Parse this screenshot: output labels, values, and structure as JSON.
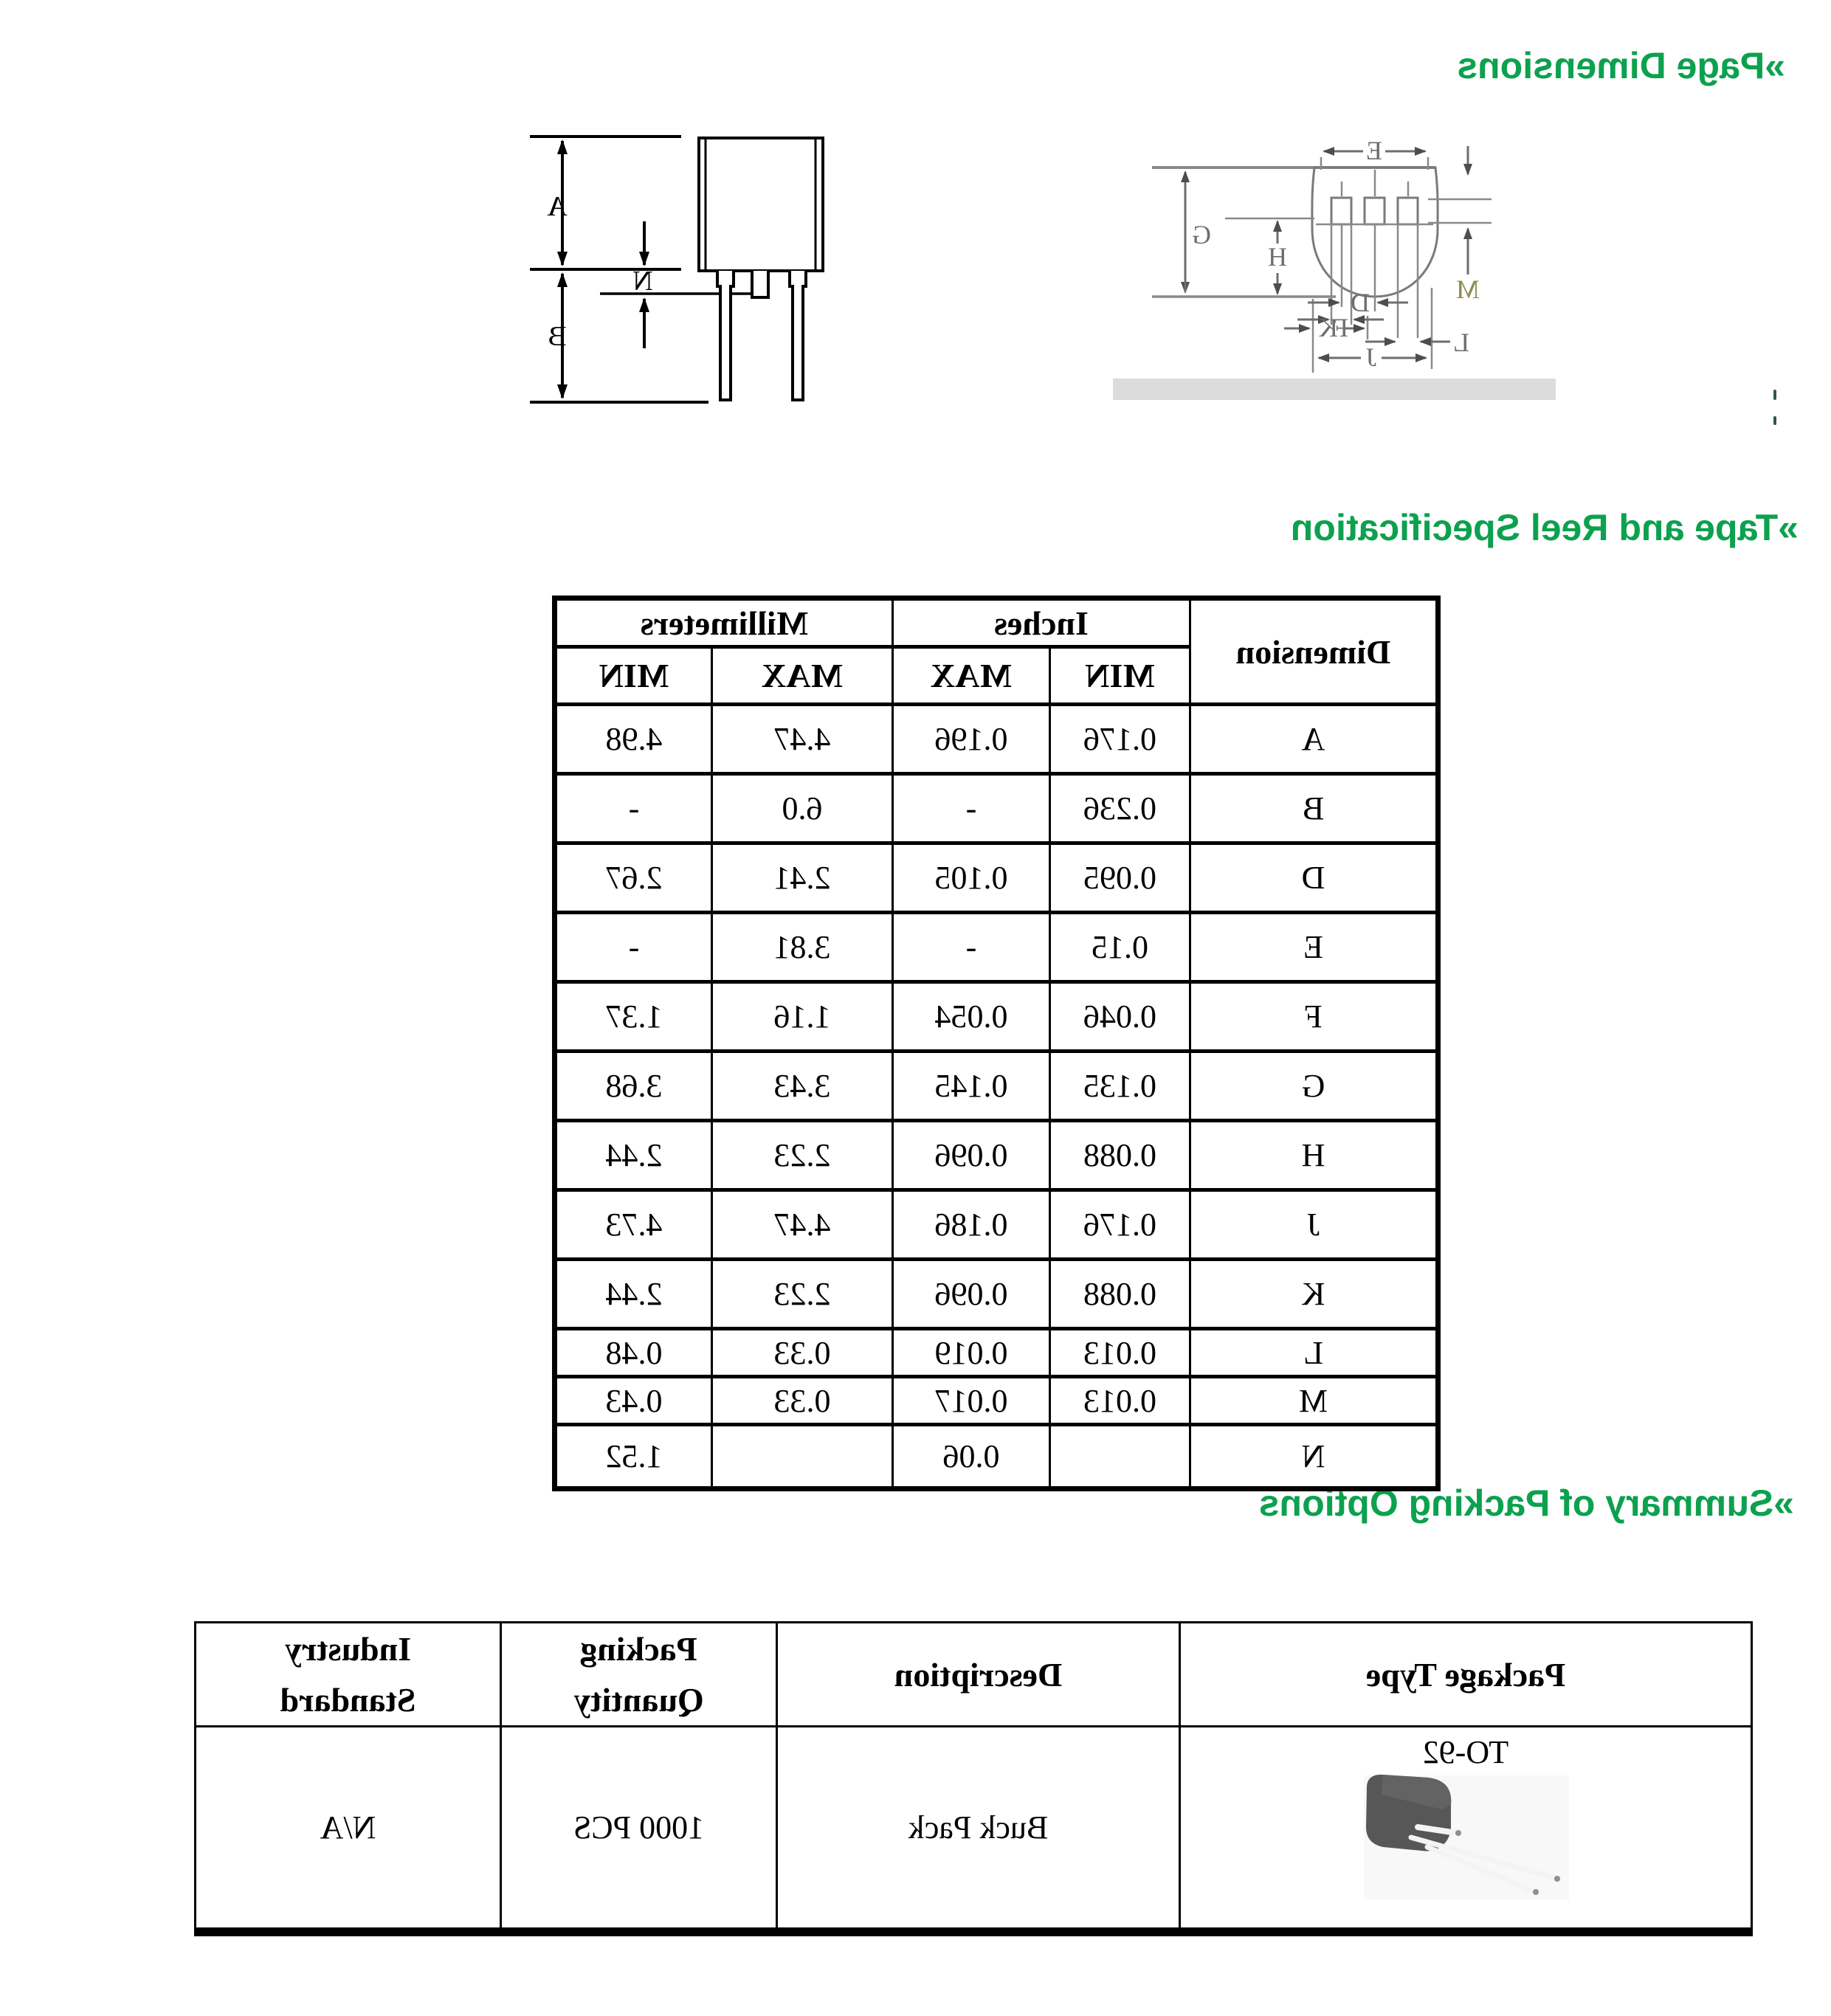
{
  "headings": {
    "h1": "»Page Dimensions",
    "h2": "»Tape and Reel Specification",
    "h3": "»Summary of Packing Options"
  },
  "colors": {
    "accent_green": "#0CA14E"
  },
  "side_view": {
    "labels": {
      "a": "A",
      "b": "B",
      "n": "N"
    }
  },
  "bottom_view": {
    "labels": {
      "e": "E",
      "g": "G",
      "h": "H",
      "m": "M",
      "f": "F",
      "l": "L",
      "d": "D",
      "k": "K",
      "j": "J"
    }
  },
  "dimensions_table": {
    "dimension_header": "Dimension",
    "inches_header": "Inches",
    "millimeters_header": "Millimeters",
    "sub_headers": [
      "MIN",
      "MAX",
      "MAX",
      "MIN"
    ],
    "rows": [
      {
        "dim": "A",
        "in_min": "0.176",
        "in_max": "0.196",
        "mm_a": "4.47",
        "mm_b": "4.98"
      },
      {
        "dim": "B",
        "in_min": "0.236",
        "in_max": "-",
        "mm_a": "6.0",
        "mm_b": "-"
      },
      {
        "dim": "D",
        "in_min": "0.095",
        "in_max": "0.105",
        "mm_a": "2.41",
        "mm_b": "2.67"
      },
      {
        "dim": "E",
        "in_min": "0.15",
        "in_max": "-",
        "mm_a": "3.81",
        "mm_b": "-"
      },
      {
        "dim": "F",
        "in_min": "0.046",
        "in_max": "0.054",
        "mm_a": "1.16",
        "mm_b": "1.37"
      },
      {
        "dim": "G",
        "in_min": "0.135",
        "in_max": "0.145",
        "mm_a": "3.43",
        "mm_b": "3.68"
      },
      {
        "dim": "H",
        "in_min": "0.088",
        "in_max": "0.096",
        "mm_a": "2.23",
        "mm_b": "2.44"
      },
      {
        "dim": "J",
        "in_min": "0.176",
        "in_max": "0.186",
        "mm_a": "4.47",
        "mm_b": "4.73"
      },
      {
        "dim": "K",
        "in_min": "0.088",
        "in_max": "0.096",
        "mm_a": "2.23",
        "mm_b": "2.44"
      },
      {
        "dim": "L",
        "in_min": "0.013",
        "in_max": "0.019",
        "mm_a": "0.33",
        "mm_b": "0.48"
      },
      {
        "dim": "M",
        "in_min": "0.013",
        "in_max": "0.017",
        "mm_a": "0.33",
        "mm_b": "0.43"
      },
      {
        "dim": "N",
        "in_min": "",
        "in_max": "0.06",
        "mm_a": "",
        "mm_b": "1.52"
      }
    ]
  },
  "packing_table": {
    "headers": {
      "package_type": "Package Type",
      "description": "Description",
      "packing_quantity_line1": "Packing",
      "packing_quantity_line2": "Quantity",
      "industry_standard_line1": "Industry",
      "industry_standard_line2": "Standard"
    },
    "row": {
      "package_type": "TO-92",
      "description": "Buck Pack",
      "packing_quantity": "1000 PCS",
      "industry_standard": "N/A"
    }
  }
}
